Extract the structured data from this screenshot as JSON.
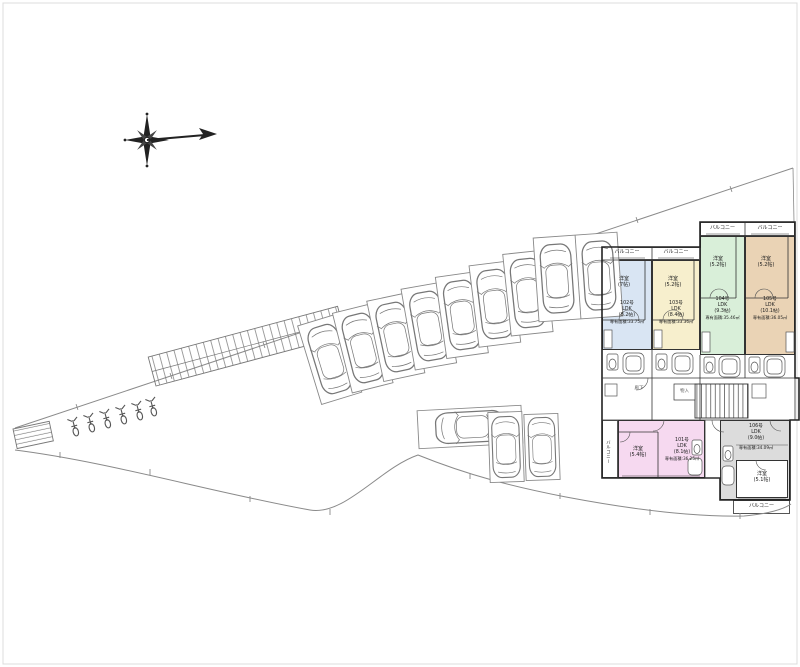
{
  "units": [
    {
      "no": "101号",
      "ldk": "LDK",
      "ldk_size": "(8.1帖)",
      "area": "専有面積:36.25㎡",
      "room": "洋室",
      "room_size": "(5.4帖)",
      "color": "#f6d9f0"
    },
    {
      "no": "102号",
      "ldk": "LDK",
      "ldk_size": "(8.2帖)",
      "area": "専有面積:33.75㎡",
      "room": "洋室",
      "room_size": "(7帖)",
      "color": "#d9e5f3"
    },
    {
      "no": "103号",
      "ldk": "LDK",
      "ldk_size": "(8.4帖)",
      "area": "専有面積:33.36㎡",
      "room": "洋室",
      "room_size": "(5.2帖)",
      "color": "#f7efcd"
    },
    {
      "no": "104号",
      "ldk": "LDK",
      "ldk_size": "(9.3帖)",
      "area": "専有面積:35.46㎡",
      "room": "洋室",
      "room_size": "(5.2帖)",
      "color": "#d9efd9"
    },
    {
      "no": "105号",
      "ldk": "LDK",
      "ldk_size": "(10.1帖)",
      "area": "専有面積:36.05㎡",
      "room": "洋室",
      "room_size": "(5.2帖)",
      "color": "#ead3b5"
    },
    {
      "no": "106号",
      "ldk": "LDK",
      "ldk_size": "(9.0帖)",
      "area": "専有面積:34.09㎡",
      "room": "洋室",
      "room_size": "(5.1帖)",
      "color": "#dcdcdc"
    }
  ],
  "labels": {
    "balcony": "バルコニー",
    "corridor": "廊下",
    "storage": "物入"
  },
  "colors": {
    "wall_line": "#333333",
    "site_line": "#8a8a8a",
    "vehicle_line": "#777777"
  }
}
